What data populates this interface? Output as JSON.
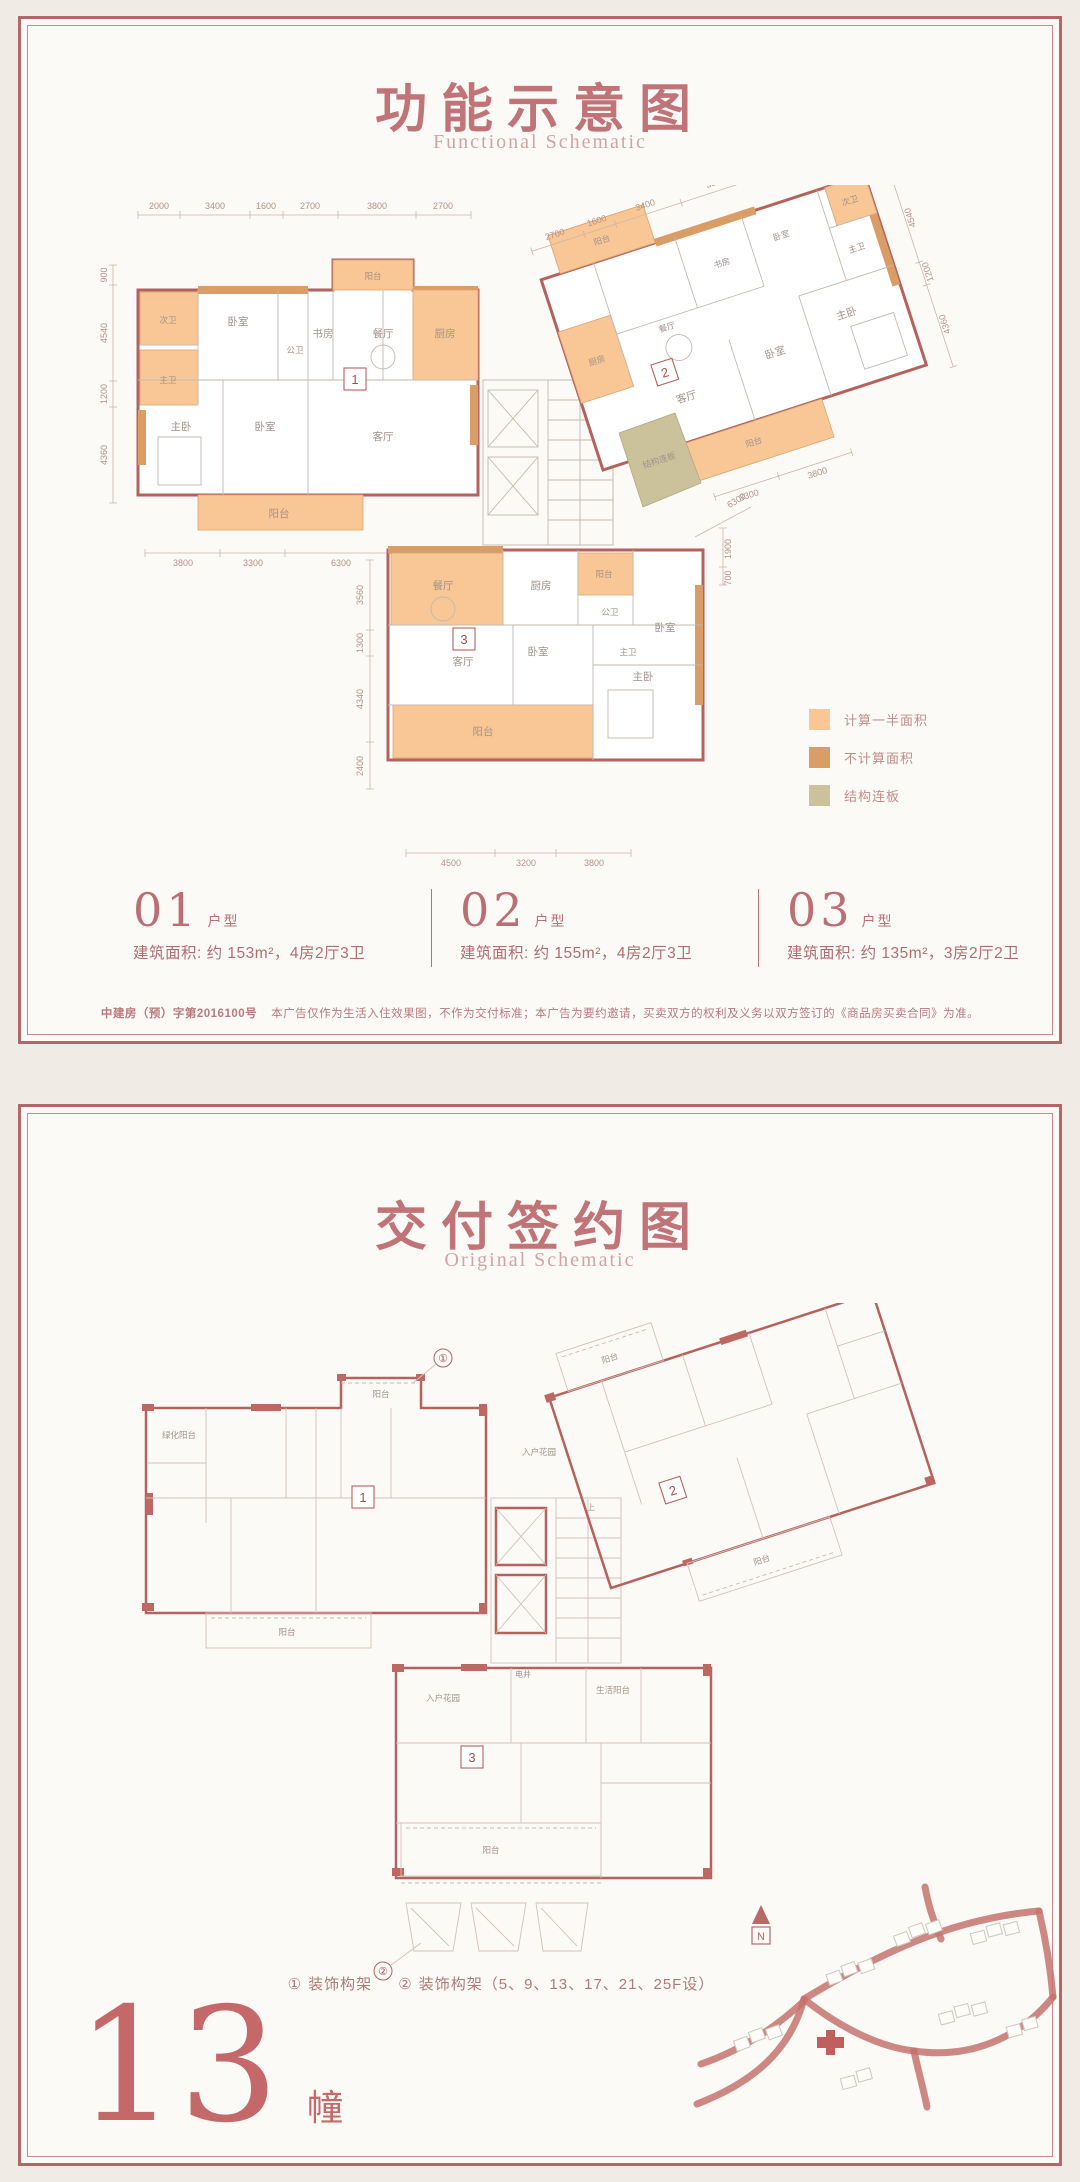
{
  "page": {
    "bg_color": "#f0ebe5",
    "panel_bg": "#fcfaf6",
    "frame_color": "#b5666b"
  },
  "panel1": {
    "title": "功能示意图",
    "subtitle": "Functional Schematic",
    "legend": {
      "items": [
        {
          "label": "计算一半面积",
          "color": "#f9c795"
        },
        {
          "label": "不计算面积",
          "color": "#db9d66"
        },
        {
          "label": "结构连板",
          "color": "#cbc29b"
        }
      ]
    },
    "units": [
      {
        "num": "01",
        "suffix": "户型",
        "desc": "建筑面积: 约 153m²，4房2厅3卫"
      },
      {
        "num": "02",
        "suffix": "户型",
        "desc": "建筑面积: 约 155m²，4房2厅3卫"
      },
      {
        "num": "03",
        "suffix": "户型",
        "desc": "建筑面积: 约 135m²，3房2厅2卫"
      }
    ],
    "disclaimer": {
      "code": "中建房（预）字第2016100号",
      "text": "本广告仅作为生活入住效果图，不作为交付标准；本广告为要约邀请，买卖双方的权利及义务以双方签订的《商品房买卖合同》为准。"
    },
    "plan": {
      "core_label": "上",
      "markers": {
        "u1": "1",
        "u2": "2",
        "u3": "3"
      },
      "unit1_rooms": [
        "次卫",
        "卧室",
        "公卫",
        "书房",
        "餐厅",
        "阳台",
        "厨房",
        "主卫",
        "主卧",
        "卧室",
        "客厅",
        "阳台"
      ],
      "unit2_rooms": [
        "阳台",
        "厨房",
        "餐厅",
        "书房",
        "卧室",
        "次卫",
        "主卫",
        "主卧",
        "卧室",
        "客厅",
        "阳台",
        "结构连板"
      ],
      "unit3_rooms": [
        "餐厅",
        "厨房",
        "阳台",
        "公卫",
        "卧室",
        "主卫",
        "客厅",
        "卧室",
        "主卧",
        "阳台"
      ],
      "dims": {
        "top": [
          "2000",
          "3400",
          "1600",
          "2700",
          "3800",
          "2700"
        ],
        "left": [
          "900",
          "4540",
          "1200",
          "4360"
        ],
        "bottom_left": [
          "3800",
          "3300",
          "6300"
        ],
        "bottom": [
          "4500",
          "3200",
          "3800"
        ],
        "unit3_left": [
          "3560",
          "1300",
          "4340",
          "2400"
        ],
        "unit3_right": [
          "1900",
          "700"
        ],
        "right_leader": "6300",
        "unit2_top": [
          "2700",
          "1600",
          "3400",
          "3800"
        ],
        "unit2_right": [
          "4540",
          "1200",
          "4360"
        ],
        "unit2_bottom": [
          "3300",
          "3800"
        ]
      }
    }
  },
  "panel2": {
    "title": "交付签约图",
    "subtitle": "Original Schematic",
    "notes": {
      "marker1": "①",
      "text1": "装饰构架",
      "marker2": "②",
      "text2": "装饰构架（5、9、13、17、21、25F设）"
    },
    "building": {
      "number": "13",
      "unit": "幢"
    },
    "plan": {
      "core_label": "上",
      "markers": {
        "u1": "1",
        "u2": "2",
        "u3": "3",
        "deco1": "①",
        "deco2": "②"
      },
      "labels": {
        "green_balcony": "绿化阳台",
        "balcony_top": "阳台",
        "entry_garden_1": "入户花园",
        "balcony_u1_bottom": "阳台",
        "shaft": "电井",
        "entry_garden_3": "入户花园",
        "living_balcony": "生活阳台",
        "balcony_u3_bottom": "阳台",
        "balcony_u2_top": "阳台",
        "balcony_u2_bottom": "阳台"
      }
    },
    "sitemap": {
      "north_label": "N"
    }
  }
}
